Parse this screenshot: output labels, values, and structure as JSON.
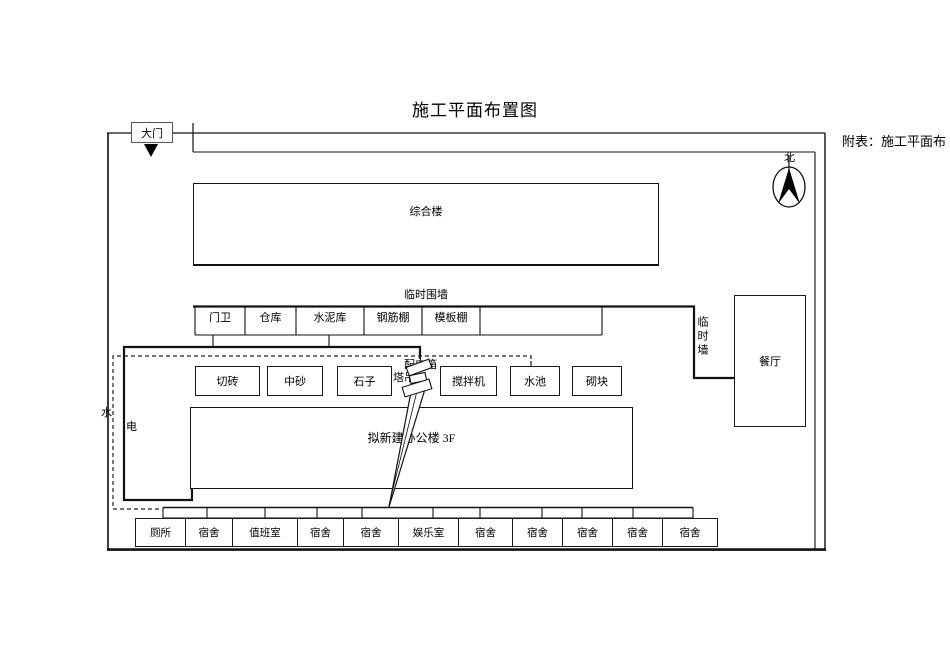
{
  "page": {
    "title": "施工平面布置图",
    "side_note": "附表：施工平面布"
  },
  "site": {
    "gate_label": "大门",
    "north_label": "北",
    "perimeter_wall_label": "临时围墙",
    "side_wall_label": "临时墙",
    "water_label": "水",
    "electric_label": "电",
    "power_box_label": "配电箱",
    "tower_crane_label": "塔吊"
  },
  "buildings": {
    "comprehensive_building": "综合楼",
    "office_building": "拟新建办公楼 3F",
    "dining_hall": "餐厅"
  },
  "facility_row": [
    "门卫",
    "仓库",
    "水泥库",
    "钢筋棚",
    "模板棚"
  ],
  "material_row": [
    "切砖",
    "中砂",
    "石子",
    "搅拌机",
    "水池",
    "砌块"
  ],
  "dorm_row": [
    "厕所",
    "宿舍",
    "值班室",
    "宿舍",
    "宿舍",
    "娱乐室",
    "宿舍",
    "宿舍",
    "宿舍",
    "宿舍",
    "宿舍"
  ]
}
